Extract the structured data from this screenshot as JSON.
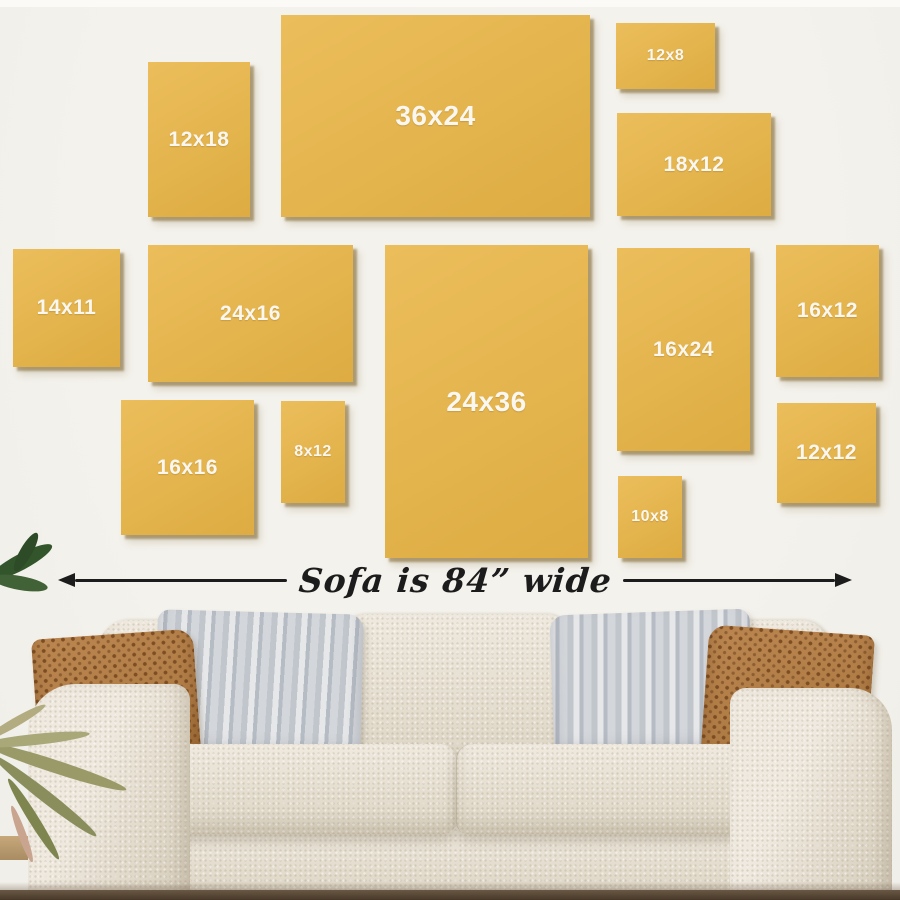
{
  "colors": {
    "wall": "#f1efe9",
    "wall_top": "#fbfaf7",
    "frame": "#e9b545",
    "frame_shadow": "rgba(122,92,30,0.5)",
    "frame_label": "#faf7f0",
    "arrow": "#1c1c1c",
    "pillow_brown": "#b07c46",
    "pillow_brown_dot": "#7d4e23",
    "floor_dark": "#463828"
  },
  "frames": {
    "items": [
      {
        "label": "12x18",
        "x": 148,
        "y": 62,
        "w": 102,
        "h": 155,
        "size": "md"
      },
      {
        "label": "36x24",
        "x": 281,
        "y": 15,
        "w": 309,
        "h": 202,
        "size": "lg"
      },
      {
        "label": "12x8",
        "x": 616,
        "y": 23,
        "w": 99,
        "h": 66,
        "size": "sm"
      },
      {
        "label": "18x12",
        "x": 617,
        "y": 113,
        "w": 154,
        "h": 103,
        "size": "md"
      },
      {
        "label": "14x11",
        "x": 13,
        "y": 249,
        "w": 107,
        "h": 118,
        "size": "md"
      },
      {
        "label": "24x16",
        "x": 148,
        "y": 245,
        "w": 205,
        "h": 137,
        "size": "md"
      },
      {
        "label": "24x36",
        "x": 385,
        "y": 245,
        "w": 203,
        "h": 313,
        "size": "lg"
      },
      {
        "label": "16x24",
        "x": 617,
        "y": 248,
        "w": 133,
        "h": 203,
        "size": "md"
      },
      {
        "label": "16x12",
        "x": 776,
        "y": 245,
        "w": 103,
        "h": 132,
        "size": "md"
      },
      {
        "label": "16x16",
        "x": 121,
        "y": 400,
        "w": 133,
        "h": 135,
        "size": "md"
      },
      {
        "label": "8x12",
        "x": 281,
        "y": 401,
        "w": 64,
        "h": 102,
        "size": "sm"
      },
      {
        "label": "10x8",
        "x": 618,
        "y": 476,
        "w": 64,
        "h": 82,
        "size": "sm"
      },
      {
        "label": "12x12",
        "x": 777,
        "y": 403,
        "w": 99,
        "h": 100,
        "size": "md"
      }
    ]
  },
  "dimension": {
    "label": "Sofa is 84” wide"
  }
}
